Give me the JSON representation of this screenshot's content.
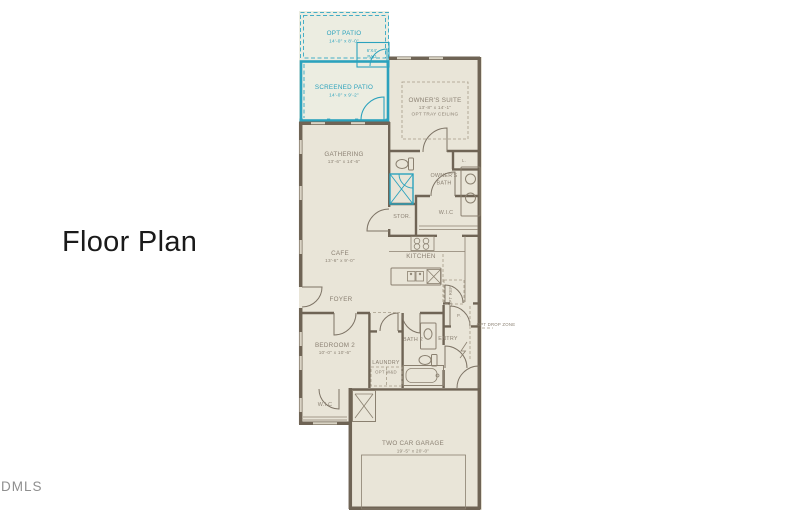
{
  "page": {
    "title": "Floor Plan",
    "watermark": "DMLS"
  },
  "colors": {
    "background": "#ffffff",
    "floor": "#e9e5d8",
    "wall": "#6f6455",
    "patio_accent": "#2ba2bd",
    "label_text": "#8b8173",
    "title_text": "#1a1a1a",
    "watermark_text": "#8f8f8f"
  },
  "plan": {
    "opt_patio": {
      "name": "OPT PATIO",
      "dims": "14'-0\" x 8'-0\""
    },
    "pad": {
      "line1": "6'X4'",
      "line2": "PAD"
    },
    "screened_patio": {
      "name": "SCREENED PATIO",
      "dims": "14'-0\" x 9'-2\""
    },
    "owners_suite": {
      "name": "OWNER'S SUITE",
      "dims": "13'-8\" x 14'-1\"",
      "note": "OPT TRAY CEILING"
    },
    "gathering": {
      "name": "GATHERING",
      "dims": "13'-6\" x 14'-6\""
    },
    "owners_bath": {
      "line1": "OWNER'S",
      "line2": "BATH"
    },
    "stor": {
      "name": "STOR."
    },
    "wic": {
      "name": "W.I.C"
    },
    "linen": {
      "name": "L."
    },
    "kitchen": {
      "name": "KITCHEN"
    },
    "cafe": {
      "name": "CAFE",
      "dims": "13'-6\" x 9'-0\""
    },
    "foyer": {
      "name": "FOYER"
    },
    "pantry": {
      "name": "P."
    },
    "entry": {
      "name": "ENTRY"
    },
    "opt_ref": {
      "name": "OPT REF"
    },
    "drop_zone": {
      "name": "OPT DROP ZONE"
    },
    "bedroom2": {
      "name": "BEDROOM 2",
      "dims": "10'-0\" x 10'-6\""
    },
    "laundry": {
      "name": "LAUNDRY",
      "note": "OPT W&D"
    },
    "bath2": {
      "name": "BATH 2"
    },
    "wic2": {
      "name": "W.I.C"
    },
    "garage": {
      "name": "TWO CAR GARAGE",
      "dims": "19'-5\" x 20'-0\""
    }
  }
}
